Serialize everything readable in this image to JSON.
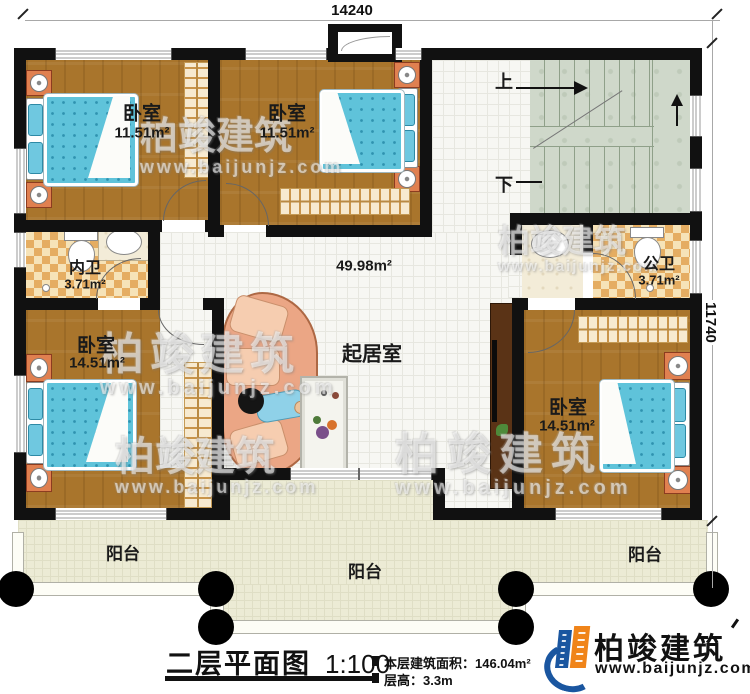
{
  "dimensions": {
    "width_label": "14240",
    "height_label": "11740"
  },
  "rooms": {
    "bedroom_top_left": {
      "name": "卧室",
      "area": "11.51m²"
    },
    "bedroom_top_mid": {
      "name": "卧室",
      "area": "11.51m²"
    },
    "bedroom_bottom_left": {
      "name": "卧室",
      "area": "14.51m²"
    },
    "bedroom_bottom_right": {
      "name": "卧室",
      "area": "14.51m²"
    },
    "bath_inner": {
      "name": "内卫",
      "area": "3.71m²"
    },
    "bath_public": {
      "name": "公卫",
      "area": "3.71m²"
    },
    "living": {
      "name": "起居室",
      "area": "49.98m²"
    }
  },
  "balconies": [
    "阳台",
    "阳台",
    "阳台"
  ],
  "stairs": {
    "up": "上",
    "down": "下"
  },
  "footer": {
    "title": "二层平面图",
    "scale": "1:100",
    "floor_area": "本层建筑面积：146.04m²",
    "floor_height": "层高：3.3m"
  },
  "logo": {
    "name": "柏竣建筑",
    "url": "www.baijunjz.com"
  },
  "watermark": {
    "text": "柏竣建筑",
    "url": "www.baijunjz.com"
  },
  "colors": {
    "wall": "#111111",
    "wood_floor": "#a9752c",
    "tile_floor": "#f7f7f3",
    "checker": "#e5ad62",
    "stair_floor": "#cfd8ca",
    "balcony_floor": "#ecebd5",
    "mattress": "#62c5dc",
    "sofa": "#eba685",
    "logo_blue": "#1a56a0",
    "logo_orange": "#f08419"
  }
}
